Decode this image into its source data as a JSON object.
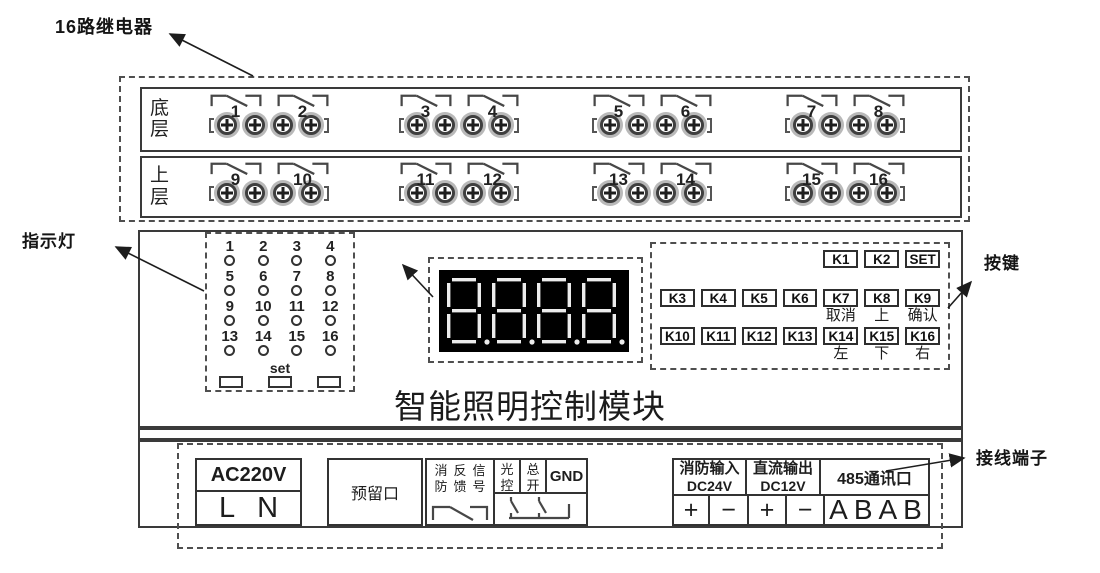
{
  "annotations": {
    "relay_bank": "16路继电器",
    "indicators": "指示灯",
    "digit_display": "数码管",
    "keypad": "按键",
    "terminals": "接线端子"
  },
  "title": "智能照明控制模块",
  "relay_bank": {
    "rows": [
      {
        "label": "底层",
        "channels": [
          "1",
          "2",
          "3",
          "4",
          "5",
          "6",
          "7",
          "8"
        ]
      },
      {
        "label": "上层",
        "channels": [
          "9",
          "10",
          "11",
          "12",
          "13",
          "14",
          "15",
          "16"
        ]
      }
    ]
  },
  "indicator_panel": {
    "led_numbers": [
      "1",
      "2",
      "3",
      "4",
      "5",
      "6",
      "7",
      "8",
      "9",
      "10",
      "11",
      "12",
      "13",
      "14",
      "15",
      "16"
    ],
    "set_label": "set"
  },
  "keypad": {
    "row1": [
      "K1",
      "K2",
      "SET"
    ],
    "row2": [
      "K3",
      "K4",
      "K5",
      "K6",
      "K7",
      "K8",
      "K9"
    ],
    "row2_captions": [
      "取消",
      "上",
      "确认"
    ],
    "row3": [
      "K10",
      "K11",
      "K12",
      "K13",
      "K14",
      "K15",
      "K16"
    ],
    "row3_captions": [
      "左",
      "下",
      "右"
    ]
  },
  "terminal_strip": {
    "ac_power": {
      "header": "AC220V",
      "line": "L",
      "neutral": "N"
    },
    "reserved": {
      "label": "预留口"
    },
    "fire_feedback": {
      "columns": [
        "消防",
        "反馈",
        "信号"
      ]
    },
    "inputs": {
      "light_control": "光控",
      "master_switch": "总开",
      "ground": "GND"
    },
    "fire_input": {
      "title": "消防输入",
      "voltage": "DC24V",
      "positive": "+",
      "negative": "−"
    },
    "dc_output": {
      "title": "直流输出",
      "voltage": "DC12V",
      "positive": "+",
      "negative": "−"
    },
    "comm_485": {
      "title": "485通讯口",
      "terminals": "ABAB"
    }
  },
  "colors": {
    "ink": "#2b2b2b",
    "display_bg": "#000000",
    "display_segment": "#ececec"
  }
}
